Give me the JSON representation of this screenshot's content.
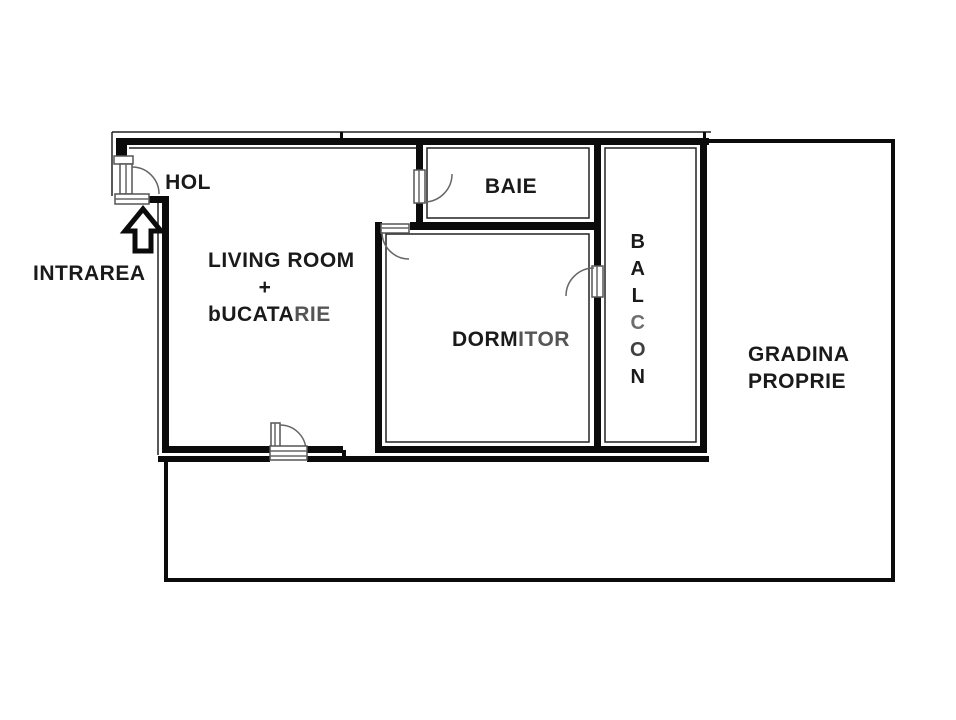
{
  "plan": {
    "title": "apartment-floor-plan",
    "labels": {
      "hall": "HOL",
      "entrance": "INTRAREA",
      "living_line1": "LIVING ROOM",
      "living_line2": "+",
      "living_line3_a": "bUCATA",
      "living_line3_b": "RIE",
      "bathroom": "BAIE",
      "bedroom_a": "DORM",
      "bedroom_b": "ITOR",
      "balcony_letters": [
        "B",
        "A",
        "L",
        "C",
        "O",
        "N"
      ],
      "garden_line1": "GRADINA",
      "garden_line2": "PROPRIE"
    },
    "icons": {
      "entrance_arrow": "up-arrow"
    },
    "colors": {
      "wall": "#0b0b0b",
      "text": "#1a1a1a",
      "text_muted": "#555555",
      "text_light": "#6e6e6e",
      "background": "#ffffff"
    }
  }
}
